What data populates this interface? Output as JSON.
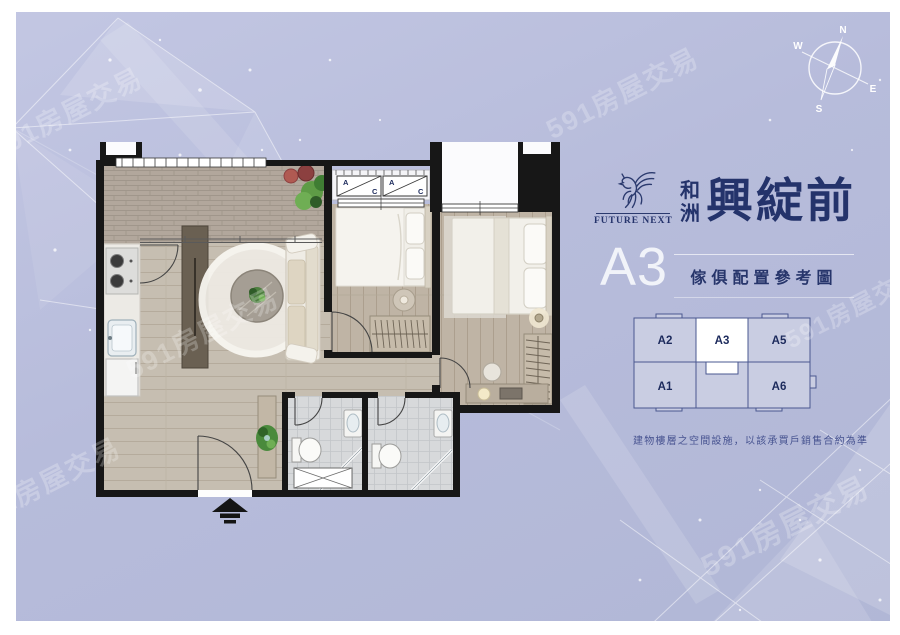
{
  "watermark": {
    "text": "591房屋交易"
  },
  "brand": {
    "logo_icon": "pegasus-icon",
    "logo_title": "FUTURE NEXT",
    "developer_line1": "和",
    "developer_line2": "洲",
    "project_name": "興綻前",
    "navy": "#24336b"
  },
  "plan_header": {
    "unit_code": "A3",
    "caption": "傢俱配置參考圖"
  },
  "keyplan": {
    "base_color": "#c9cde2",
    "highlight_color": "#ffffff",
    "outline_color": "#4a5890",
    "units": [
      {
        "id": "A2",
        "highlighted": false
      },
      {
        "id": "A3",
        "highlighted": true
      },
      {
        "id": "A5",
        "highlighted": false
      },
      {
        "id": "A1",
        "highlighted": false
      },
      {
        "id": "A6",
        "highlighted": false
      }
    ]
  },
  "disclaimer": {
    "text": "建物樓層之空間設施，以該承買戶銷售合約為準"
  },
  "compass": {
    "north": "N",
    "east": "E",
    "south": "S",
    "west": "W"
  },
  "floorplan": {
    "ac_label_a": "A",
    "ac_label_c": "C",
    "wall_color": "#171717"
  }
}
